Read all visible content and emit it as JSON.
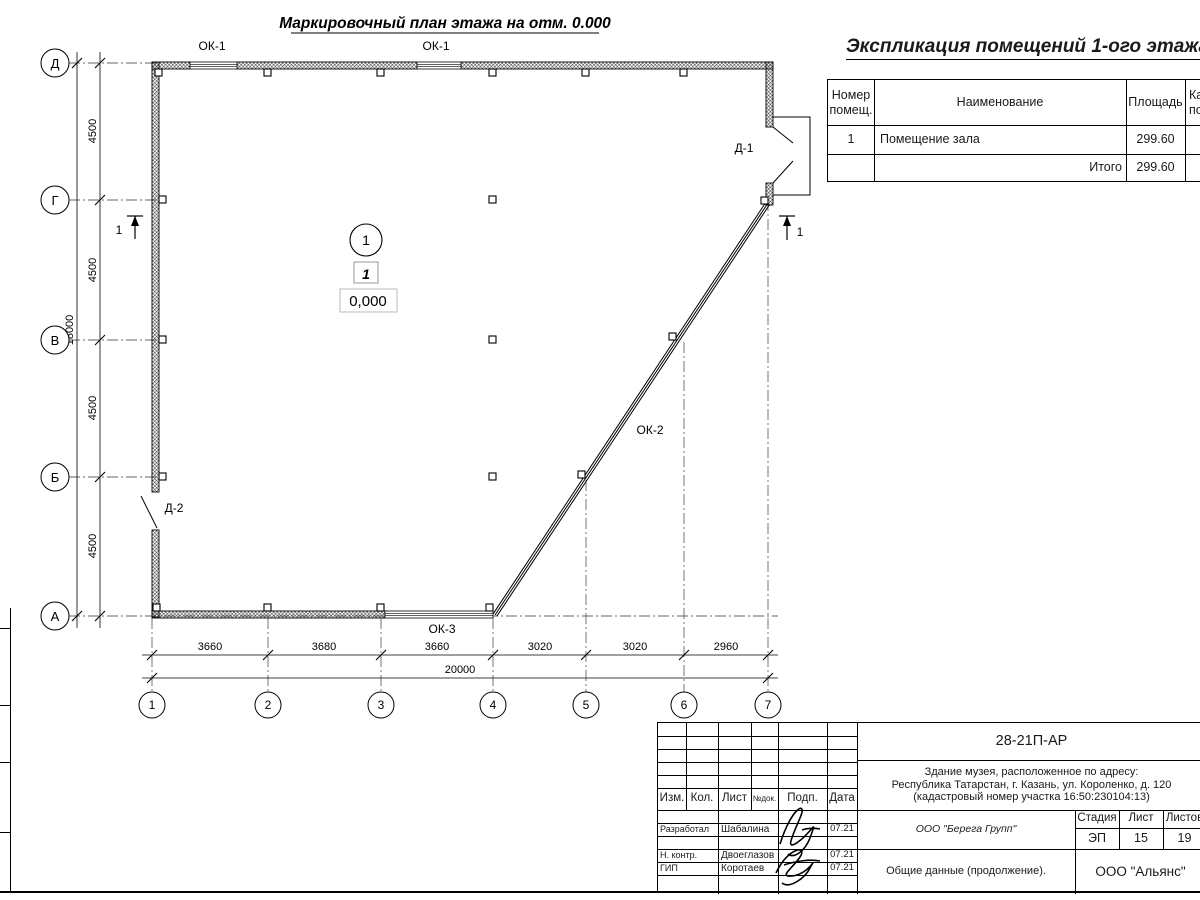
{
  "plan": {
    "title": "Маркировочный план этажа на отм. 0.000",
    "axes_bottom": [
      "1",
      "2",
      "3",
      "4",
      "5",
      "6",
      "7"
    ],
    "axes_left": [
      "Д",
      "Г",
      "В",
      "Б",
      "А"
    ],
    "dims_bottom": [
      "3660",
      "3680",
      "3660",
      "3020",
      "3020",
      "2960"
    ],
    "dim_bottom_total": "20000",
    "dims_left": [
      "4500",
      "4500",
      "4500",
      "4500"
    ],
    "dim_left_total": "18000",
    "window_labels": {
      "ok1_left": "ОК-1",
      "ok1_right": "ОК-1",
      "ok2": "ОК-2",
      "ok3": "ОК-3"
    },
    "door_labels": {
      "d1": "Д-1",
      "d2": "Д-2"
    },
    "room_marker": "1",
    "zone_marker": "1",
    "elevation": "0,000",
    "section_marks": {
      "left": "1",
      "right": "1"
    }
  },
  "explication": {
    "title": "Экспликация помещений 1-ого этажа",
    "headers": {
      "number_l1": "Номер",
      "number_l2": "помещ.",
      "name": "Наименование",
      "area": "Площадь",
      "cat_l1": "Ка",
      "cat_l2": "по"
    },
    "rows": [
      {
        "number": "1",
        "name": "Помещение зала",
        "area": "299.60"
      }
    ],
    "total_label": "Итого",
    "total_area": "299.60"
  },
  "titleblock": {
    "doc_number": "28-21П-АР",
    "address_line1": "Здание музея, расположенное по адресу:",
    "address_line2": "Республика Татарстан, г. Казань, ул. Короленко, д. 120",
    "address_line3": "(кадастровый номер участка 16:50:230104:13)",
    "cols": {
      "izm": "Изм.",
      "kol": "Кол.",
      "list": "Лист",
      "ndok": "№док.",
      "podp": "Подп.",
      "data": "Дата"
    },
    "roles": [
      {
        "role": "Разработал",
        "name": "Шабалина",
        "date": "07.21"
      },
      {
        "role": "Н. контр.",
        "name": "Двоеглазов",
        "date": "07.21"
      },
      {
        "role": "ГИП",
        "name": "Коротаев",
        "date": "07.21"
      }
    ],
    "company": "ООО \"Берега Групп\"",
    "stage_label": "Стадия",
    "sheet_label": "Лист",
    "sheets_label": "Листов",
    "stage": "ЭП",
    "sheet": "15",
    "sheets": "19",
    "doc_title": "Общие данные (продолжение).",
    "org": "ООО \"Альянс\""
  }
}
